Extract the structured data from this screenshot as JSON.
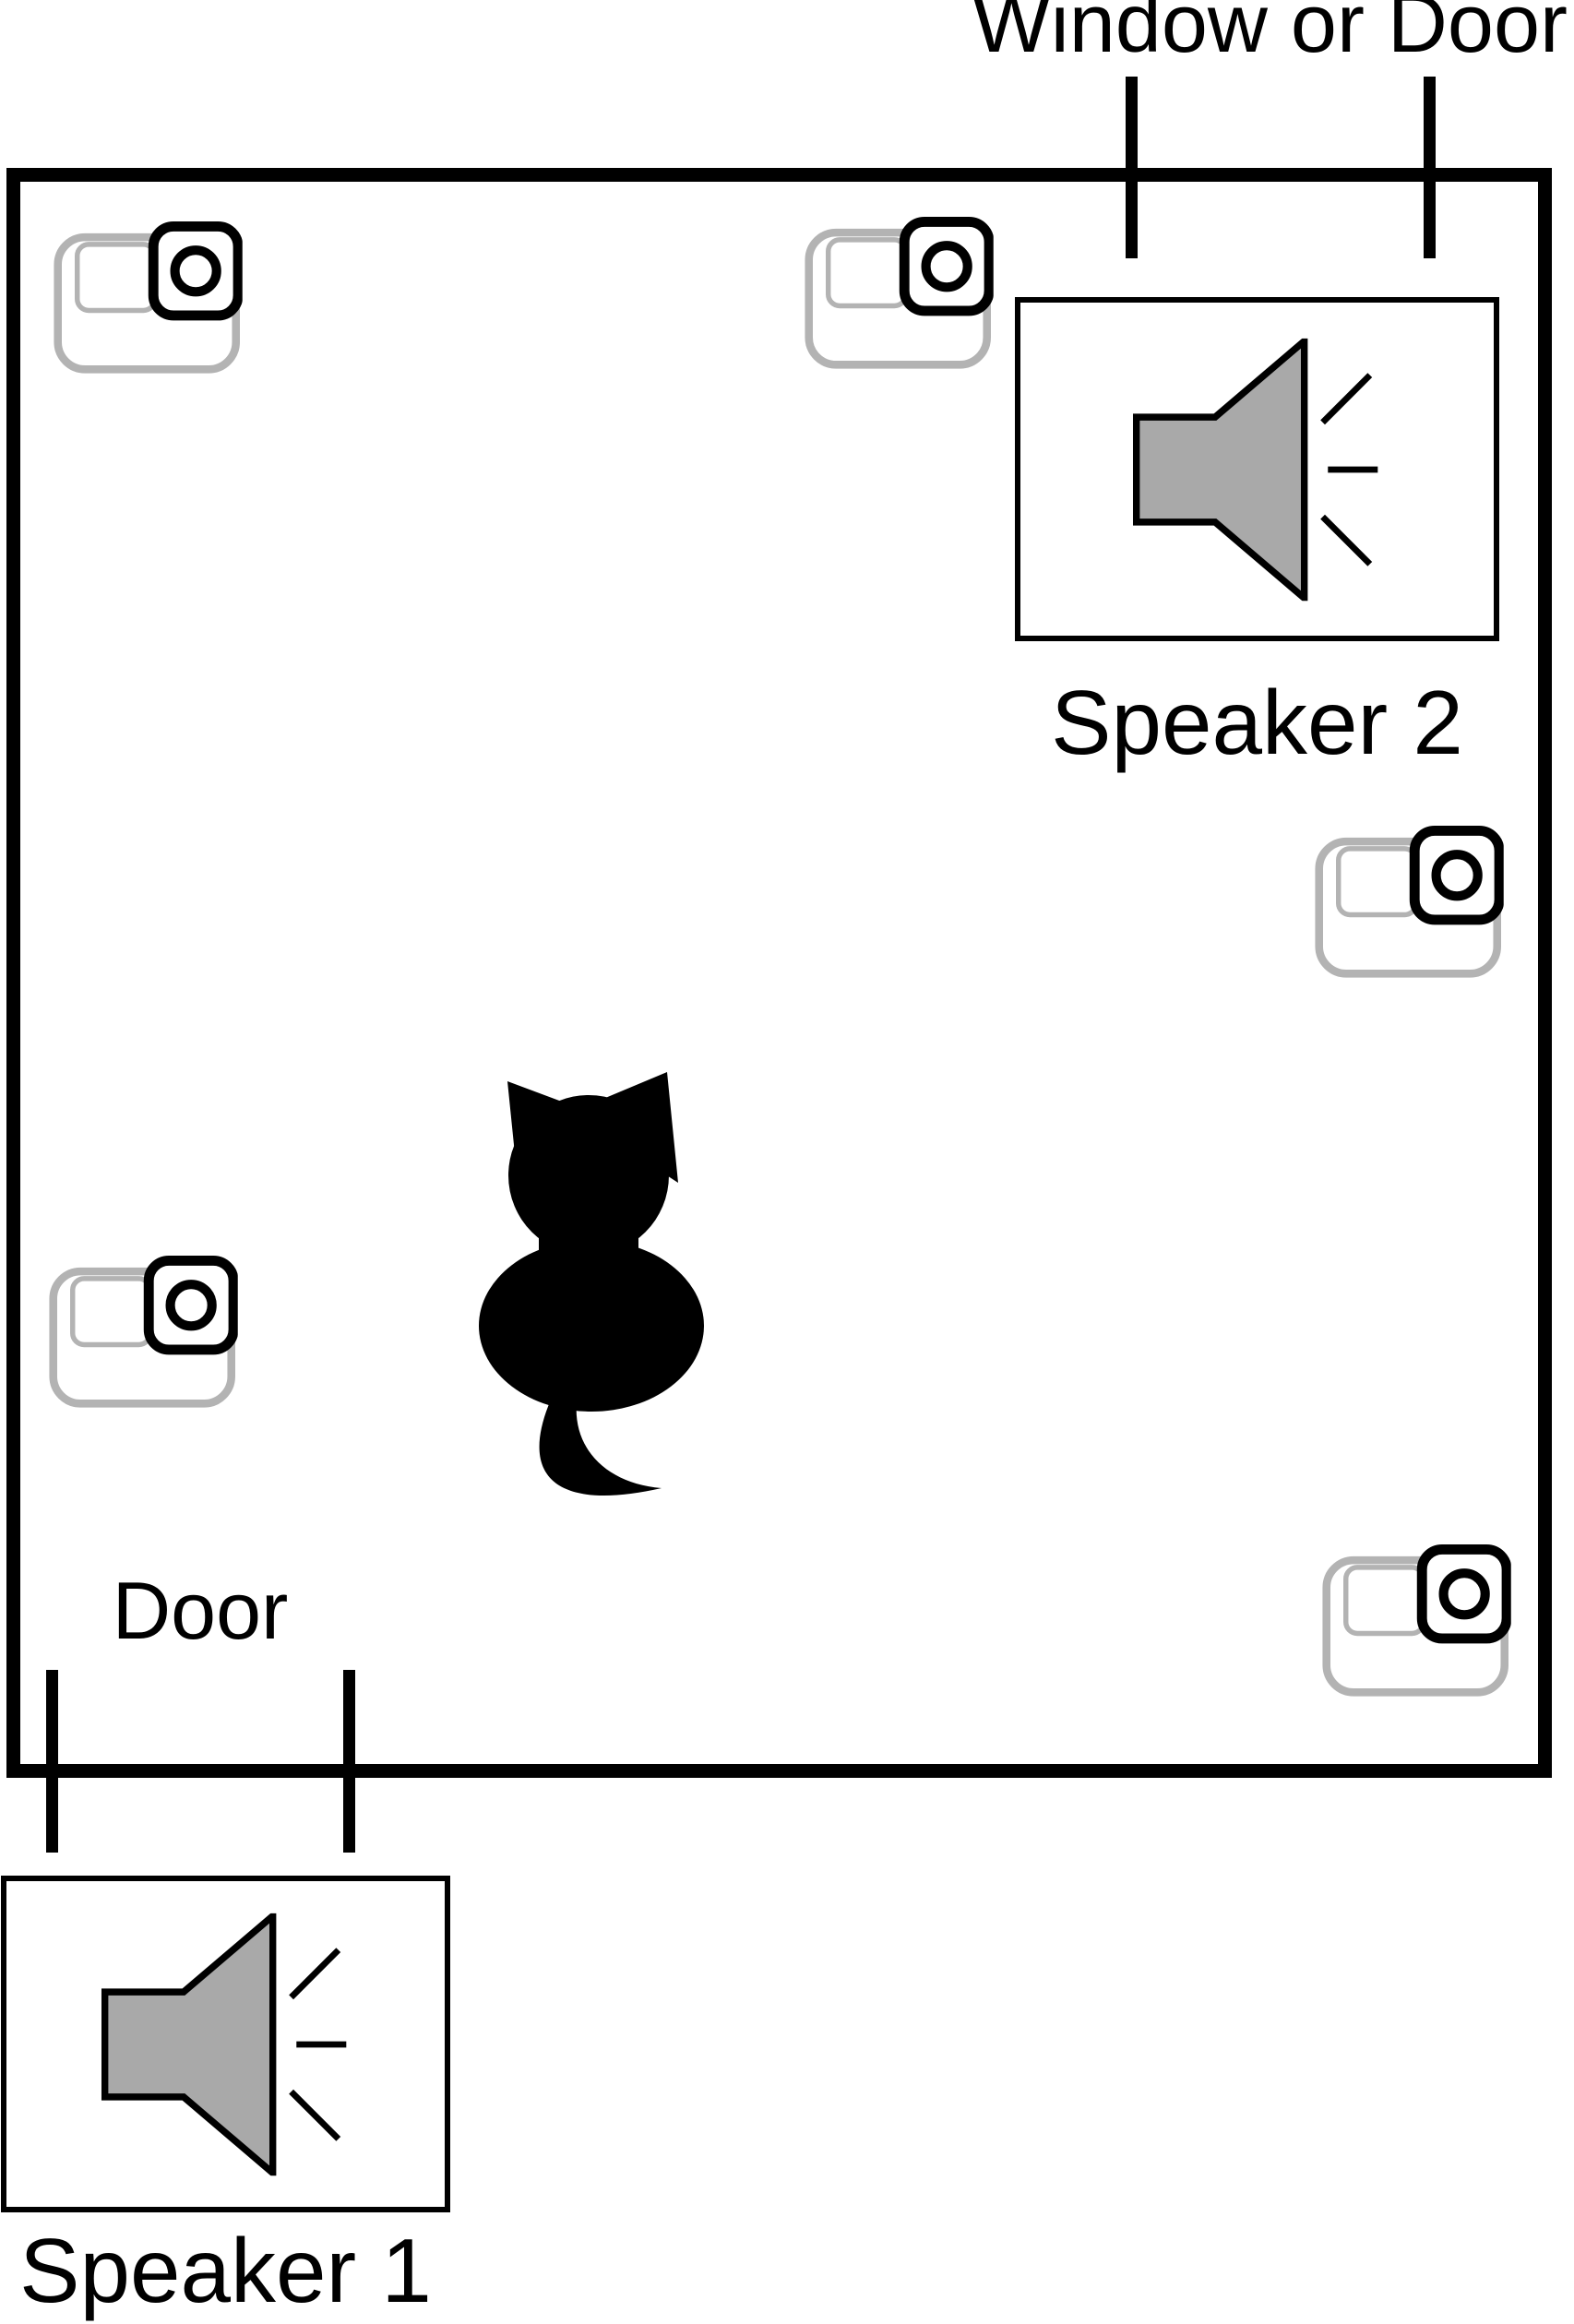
{
  "labels": {
    "window_or_door": "Window or Door",
    "speaker2": "Speaker 2",
    "door": "Door",
    "speaker1": "Speaker 1"
  },
  "icons": {
    "camera": "action-camera-icon",
    "speaker": "loudspeaker-sound-icon",
    "cat": "cat-silhouette-back-view"
  },
  "counts": {
    "cameras": 5,
    "speakers": 2,
    "door_marks": 2,
    "window_marks": 2
  },
  "colors": {
    "background": "#ffffff",
    "line": "#000000",
    "speaker_fill": "#a9a9a9",
    "camera_outline": "#b3b3b3",
    "cat_fill": "#000000"
  }
}
